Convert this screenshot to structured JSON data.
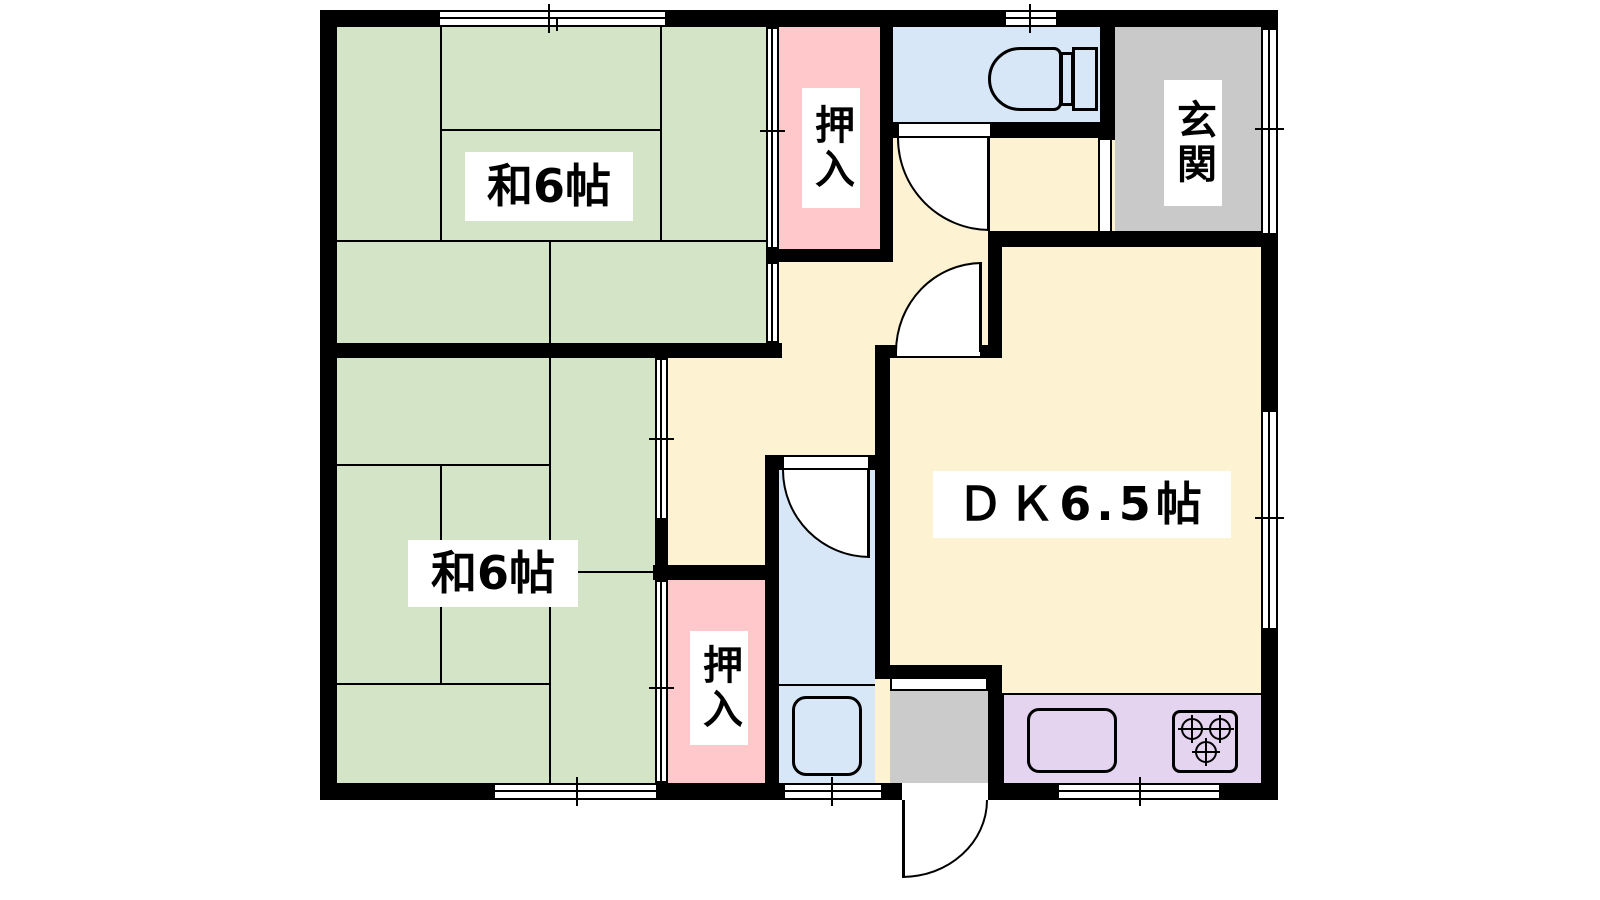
{
  "plan": {
    "type": "japanese-apartment-floor-plan",
    "rooms": [
      {
        "id": "japanese-room-upper",
        "label": "和6帖"
      },
      {
        "id": "japanese-room-lower",
        "label": "和6帖"
      },
      {
        "id": "dining-kitchen",
        "label": "ＤＫ6.5帖"
      },
      {
        "id": "entrance",
        "label": "玄関"
      },
      {
        "id": "closet-upper",
        "label": "押入"
      },
      {
        "id": "closet-lower",
        "label": "押入"
      }
    ],
    "colors": {
      "tatami_green": "#d3e5c6",
      "floor_cream": "#fdf2d1",
      "closet_pink": "#ffc8ca",
      "wet_area_blue": "#d7e7f8",
      "entrance_gray": "#c9c9c9",
      "kitchen_purple": "#e4d4ef",
      "wall_black": "#000000"
    }
  }
}
